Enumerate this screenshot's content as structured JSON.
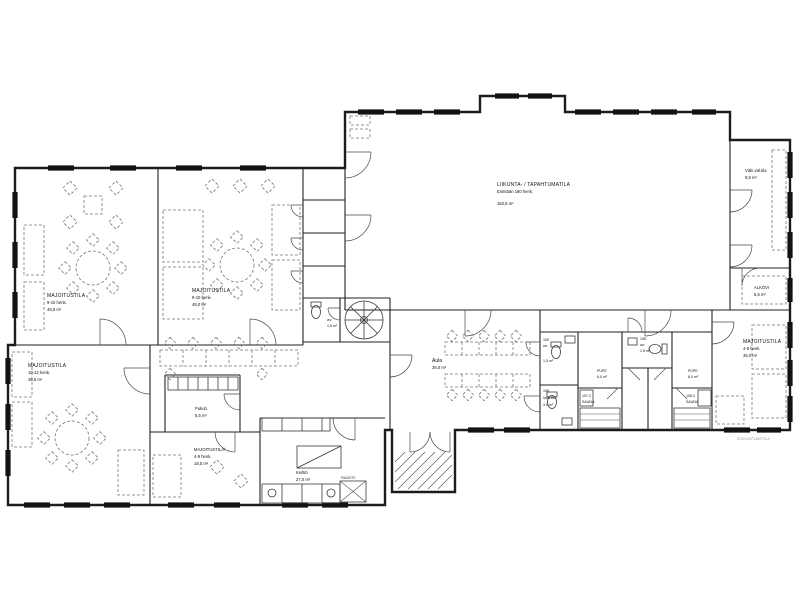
{
  "rooms": {
    "majoitustila_a": {
      "name": "MAJOITUSTILA",
      "capacity": "9-10 henk.",
      "area": "48,5 m²"
    },
    "majoitustila_b": {
      "name": "MAJOITUSTILA",
      "capacity": "9-10 henk.",
      "area": "48,0 m²"
    },
    "liikuntasali": {
      "name": "LIIKUNTA- / TAPAHTUMATILA",
      "capacity": "Enintään 180 henk.",
      "area": "163,5 m²"
    },
    "valinetila": {
      "name": "Väln.väl.tila",
      "area": "9,5 m²"
    },
    "alkovi": {
      "name": "ALKOVI",
      "area": "5,5 m²"
    },
    "majoitustila_c": {
      "name": "MAJOITUSTILA",
      "capacity": "10-12 henk.",
      "area": "46,5 m²"
    },
    "aula": {
      "name": "Aula",
      "area": "38,0 m²"
    },
    "wc_105": {
      "number": "105",
      "name": "wc",
      "area": "1,5 m²"
    },
    "wc_106": {
      "number": "106",
      "name": "Inva-wc",
      "area": "3,5 m²"
    },
    "wc_mid": {
      "number": "106",
      "name": "wc",
      "area": "1,5 m²"
    },
    "pupe_1": {
      "name": "PUPE",
      "area": "6,0 m²"
    },
    "sauna_1": {
      "number": "107.2",
      "name": "SAUNA"
    },
    "pupe_2": {
      "name": "PUPE",
      "area": "6,0 m²"
    },
    "sauna_2": {
      "number": "108.2",
      "name": "SAUNA"
    },
    "majoitustila_d": {
      "name": "MAJOITUSTILA",
      "capacity": "4-6 henk.",
      "area": "35,0 m²"
    },
    "pukuhuone": {
      "name": "Pukuh.",
      "area": "5,5 m²"
    },
    "majoitustila_e": {
      "name": "MAJOITUSTILA/",
      "capacity": "4-6 henk.",
      "area": "18,5 m²"
    },
    "keittio": {
      "name": "Keittiö",
      "area": "27,0 m²"
    },
    "wc_stair": {
      "name": "wc",
      "area": "1,5 m²"
    },
    "pakaste": {
      "name": "PAKASTE"
    }
  },
  "notes": {
    "corner_note": "KOKOONTUMISTILA"
  }
}
